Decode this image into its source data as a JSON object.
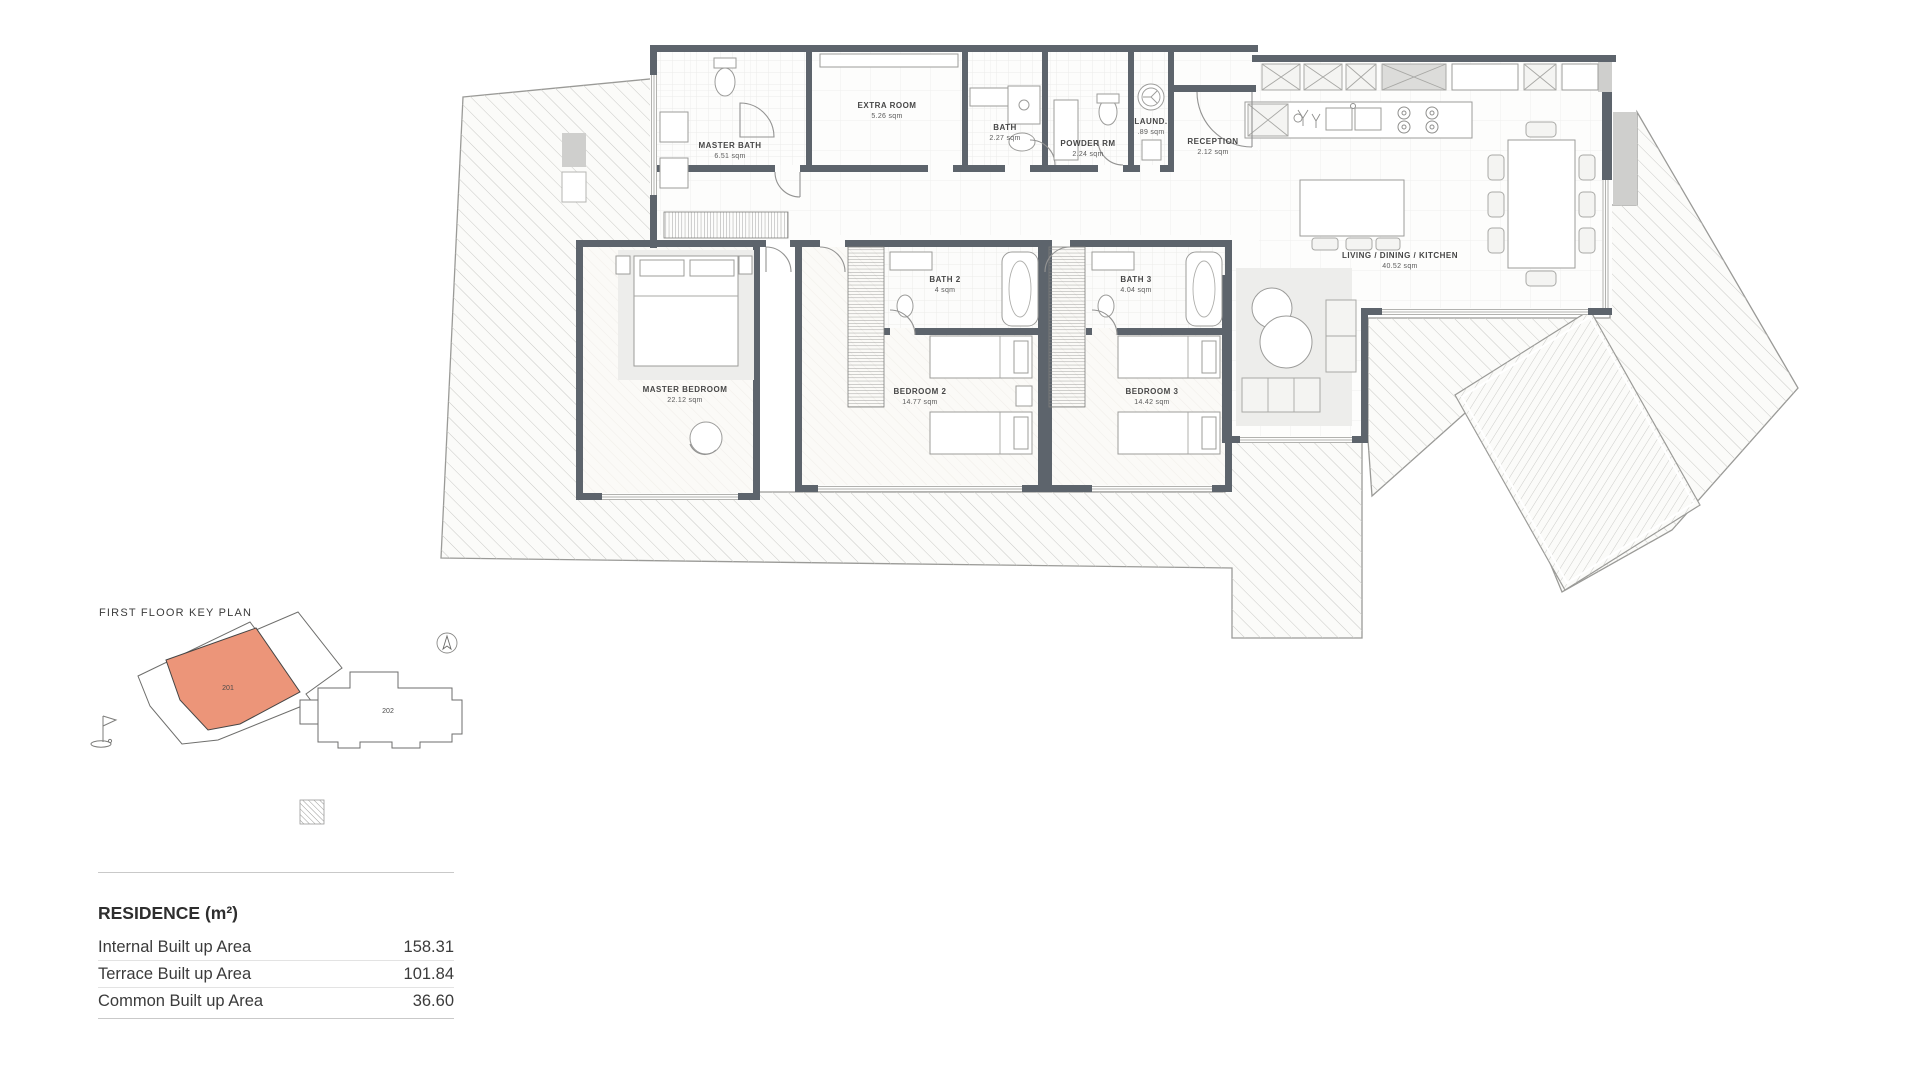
{
  "rooms": [
    {
      "name": "MASTER BATH",
      "area": "6.51 sqm"
    },
    {
      "name": "EXTRA ROOM",
      "area": "5.26 sqm"
    },
    {
      "name": "BATH",
      "area": "2.27 sqm"
    },
    {
      "name": "POWDER RM",
      "area": "2.24 sqm"
    },
    {
      "name": "LAUND.",
      "area": ".89 sqm"
    },
    {
      "name": "RECEPTION",
      "area": "2.12 sqm"
    },
    {
      "name": "LIVING / DINING / KITCHEN",
      "area": "40.52 sqm"
    },
    {
      "name": "MASTER BEDROOM",
      "area": "22.12 sqm"
    },
    {
      "name": "BATH 2",
      "area": "4 sqm"
    },
    {
      "name": "BEDROOM 2",
      "area": "14.77 sqm"
    },
    {
      "name": "BATH 3",
      "area": "4.04 sqm"
    },
    {
      "name": "BEDROOM 3",
      "area": "14.42 sqm"
    }
  ],
  "key_plan": {
    "title": "FIRST FLOOR KEY PLAN",
    "units": [
      {
        "id": "201",
        "highlighted": true
      },
      {
        "id": "202",
        "highlighted": false
      }
    ]
  },
  "residence_table": {
    "title": "RESIDENCE (m²)",
    "rows": [
      {
        "label": "Internal Built up Area",
        "value": "158.31"
      },
      {
        "label": "Terrace Built up Area",
        "value": "101.84"
      },
      {
        "label": "Common Built up Area",
        "value": "36.60"
      }
    ]
  },
  "colors": {
    "unit_highlight": "#EC9579",
    "walls": "#5D646C"
  }
}
